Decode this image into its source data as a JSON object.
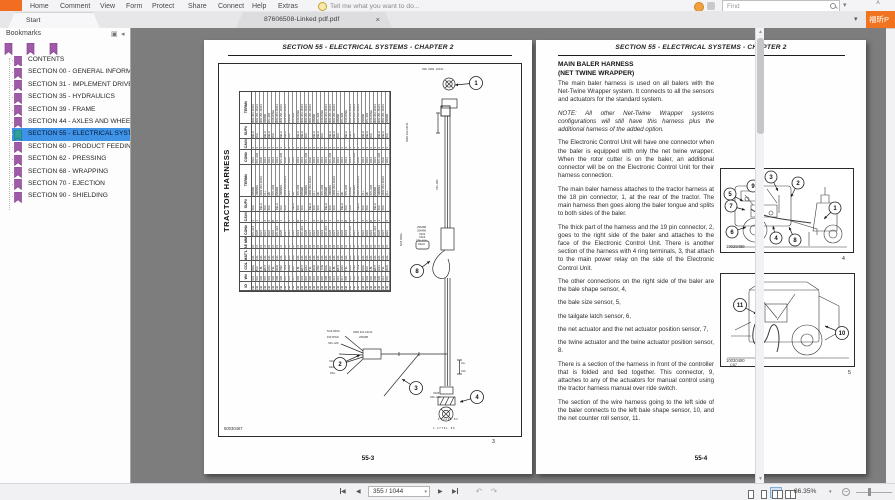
{
  "menubar": {
    "items": [
      "Home",
      "Comment",
      "View",
      "Form",
      "Protect",
      "Share",
      "Connect",
      "Help",
      "Extras"
    ],
    "assistant_hint": "Tell me what you want to do...",
    "find_placeholder": "Find",
    "brand_button": "福昕P"
  },
  "tabs": {
    "start": "Start",
    "document": "87606508-Linked pdf.pdf",
    "close": "×"
  },
  "bookmarks": {
    "title": "Bookmarks",
    "selected_index": 6,
    "items": [
      "CONTENTS",
      "SECTION 00 - GENERAL INFORMATIO",
      "SECTION 31 - IMPLEMENT DRIVELINE",
      "SECTION 35 - HYDRAULICS",
      "SECTION 39 - FRAME",
      "SECTION 44 - AXLES AND WHEELS",
      "SECTION 55 - ELECTRICAL SYSTEMS",
      "SECTION 60 - PRODUCT FEEDING",
      "SECTION 62 - PRESSING",
      "SECTION 68 - WRAPPING",
      "SECTION 70 - EJECTION",
      "SECTION 90 - SHIELDING"
    ]
  },
  "doc": {
    "left_page": {
      "header": "SECTION 55 - ELECTRICAL SYSTEMS - CHAPTER 2",
      "page_number": "55-3",
      "figure": {
        "title": "TRACTOR HARNESS",
        "image_id": "50030467",
        "figure_number": "3",
        "table": {
          "row_headers": [
            "TERM#",
            "SUP#",
            "CAV#",
            "CON#",
            "TERM#",
            "SUP#",
            "CAV#",
            "CON#",
            "SAE MM2",
            "MAT'L",
            "COL",
            "W#",
            "ID"
          ],
          "band_heights": [
            34,
            15,
            11,
            15,
            34,
            15,
            11,
            15,
            12,
            12,
            10,
            10,
            9
          ],
          "columns": 34,
          "pools": [
            [
              "0482 203-16141",
              "0482 201-16141",
              "0462 201-16141",
              "296488",
              "SPL-429",
              "5/16 RING"
            ],
            [
              "DELU",
              "-",
              "PAC",
              "DELU"
            ],
            [
              "1",
              "A",
              "C",
              "J",
              "2",
              "-",
              "3"
            ],
            [
              "X012",
              "X012",
              "X013",
              "X021",
              "SPL-004",
              "X032"
            ],
            [
              "296488",
              "2965891",
              "0482 203-16141",
              "21+",
              "3/b",
              "SPL-004"
            ],
            [
              "PAC",
              "DELU",
              "-",
              "PAC"
            ],
            [
              "3",
              "1",
              "-",
              "4",
              "2",
              "B"
            ],
            [
              "X021",
              "X022",
              "X023",
              "SPL-014",
              "X025",
              "X027"
            ],
            [
              "0.8",
              "1.0",
              "0.8",
              "2.0"
            ],
            [
              "GXL",
              "GXL",
              "GXL"
            ],
            [
              "RED",
              "BLK",
              "YEL",
              "ORG",
              "GRA",
              "TAN",
              "WHT",
              "PNK",
              "LBL"
            ],
            [
              "001",
              "003",
              "005",
              "008",
              "010",
              "012",
              "015",
              "017",
              "020",
              "023",
              "026",
              "030"
            ],
            [
              "CM"
            ]
          ]
        },
        "callouts": [
          {
            "n": "1",
            "cx": 257,
            "cy": 19,
            "tx": 236,
            "ty": 21
          },
          {
            "n": "8",
            "cx": 198,
            "cy": 207,
            "tx": 211,
            "ty": 197
          },
          {
            "n": "2",
            "cx": 121,
            "cy": 300,
            "tx": 141,
            "ty": 291
          },
          {
            "n": "3",
            "cx": 197,
            "cy": 324,
            "tx": 183,
            "ty": 315
          },
          {
            "n": "4",
            "cx": 258,
            "cy": 333,
            "tx": 241,
            "ty": 338
          }
        ],
        "micro_labels": [
          {
            "x": 203,
            "y": 6,
            "t": "298· 0482 ·16141 ··"
          },
          {
            "x": 189,
            "y": 78,
            "t": "0482 201-16141",
            "r": 1
          },
          {
            "x": 219,
            "y": 126,
            "t": "SPL-004",
            "r": 1
          },
          {
            "x": 183,
            "y": 182,
            "t": "5/16 RING",
            "r": 1
          },
          {
            "x": 198,
            "y": 164,
            "t": "296488"
          },
          {
            "x": 198,
            "y": 167.4,
            "t": "296489"
          },
          {
            "x": 200,
            "y": 170.8,
            "t": "X022"
          },
          {
            "x": 200,
            "y": 174.2,
            "t": "X023"
          },
          {
            "x": 197,
            "y": 177.6,
            "t": "SPL-014"
          },
          {
            "x": 199,
            "y": 181,
            "t": "DELU"
          },
          {
            "x": 134,
            "y": 269,
            "t": "0482 201-16141"
          },
          {
            "x": 140,
            "y": 274,
            "t": "296488"
          },
          {
            "x": 108,
            "y": 268,
            "t": "5/16 RING"
          },
          {
            "x": 108,
            "y": 274,
            "t": "#16 RING"
          },
          {
            "x": 109,
            "y": 280,
            "t": "SPL-429"
          },
          {
            "x": 110,
            "y": 298,
            "t": "X027"
          },
          {
            "x": 110,
            "y": 304,
            "t": "DELU"
          },
          {
            "x": 111,
            "y": 310,
            "t": "PAC"
          },
          {
            "x": 242,
            "y": 300,
            "t": "21+"
          },
          {
            "x": 242,
            "y": 308,
            "t": "31b"
          },
          {
            "x": 214,
            "y": 330,
            "t": "X025"
          },
          {
            "x": 211,
            "y": 334,
            "t": "SPL-413"
          },
          {
            "x": 218,
            "y": 356,
            "t": "·5 ·1 2 2 3 1 ··8 2"
          },
          {
            "x": 214,
            "y": 365,
            "t": "1·· 2 7 7 8 1 ·· 8 8"
          }
        ]
      }
    },
    "right_page": {
      "header": "SECTION 55 - ELECTRICAL SYSTEMS - CHAPTER 2",
      "page_number": "55-4",
      "title_line1": "MAIN BALER HARNESS",
      "title_line2": "(NET TWINE WRAPPER)",
      "paragraphs": [
        {
          "text": "The main baler harness is used on all balers with the Net-Twine Wrapper system. It connects to all the sensors and actuators for the standard system.",
          "italic": false
        },
        {
          "text": "NOTE: All other Net-Twine Wrapper systems configurations will still have this harness plus the additional harness of the added option.",
          "italic": true
        },
        {
          "text": "The Electronic Control Unit will have one connector when the baler is equipped with only the net twine wrapper. When the rotor cutter is on the baler, an additional connector will be on the Electronic Control Unit for their harness connection.",
          "italic": false
        },
        {
          "text": "The main baler harness attaches to the tractor harness at the 18 pin connector, 1, at the rear of the tractor. The main harness then goes along the baler tongue and splits to both sides of the baler.",
          "italic": false
        },
        {
          "text": "The thick part of the harness and the 19 pin connector, 2, goes to the right side of the baler and attaches to the face of the Electronic Control Unit. There is another section of the harness with 4 ring terminals, 3, that attach to the main power relay on the side of the Electronic Control Unit.",
          "italic": false
        },
        {
          "text": "The other connections on the right side of the baler are the bale shape sensor, 4,",
          "italic": false
        },
        {
          "text": "the bale size sensor, 5,",
          "italic": false
        },
        {
          "text": "the tailgate latch sensor, 6,",
          "italic": false
        },
        {
          "text": "the net actuator and the net actuator position sensor, 7,",
          "italic": false
        },
        {
          "text": "the twine actuator and the twine actuator position sensor, 8.",
          "italic": false
        },
        {
          "text": "There is a section of the harness in front of the controller that is folded and tied together. This connector, 9, attaches to any of the actuators for manual control using the tractor harness manual over ride switch.",
          "italic": false
        },
        {
          "text": "The section of the wire harness going to the left side of the baler connects to the left bale shape sensor, 10, and the net counter roll sensor, 11.",
          "italic": false
        }
      ],
      "figures": [
        {
          "image_id": "10029489",
          "figure_number": "4",
          "callouts": [
            {
              "n": "3",
              "cx": 50,
              "cy": 8,
              "tx": 57,
              "ty": 22
            },
            {
              "n": "2",
              "cx": 77,
              "cy": 14,
              "tx": 70,
              "ty": 28
            },
            {
              "n": "9",
              "cx": 32,
              "cy": 17,
              "tx": 42,
              "ty": 30
            },
            {
              "n": "5",
              "cx": 9,
              "cy": 25,
              "tx": 22,
              "ty": 32
            },
            {
              "n": "7",
              "cx": 10,
              "cy": 37,
              "tx": 24,
              "ty": 41
            },
            {
              "n": "1",
              "cx": 114,
              "cy": 39,
              "tx": 103,
              "ty": 50
            },
            {
              "n": "6",
              "cx": 11,
              "cy": 63,
              "tx": 25,
              "ty": 58
            },
            {
              "n": "4",
              "cx": 55,
              "cy": 69,
              "tx": 52,
              "ty": 57
            },
            {
              "n": "8",
              "cx": 74,
              "cy": 71,
              "tx": 68,
              "ty": 58
            }
          ]
        },
        {
          "image_id": "10030490",
          "sub_id": "C87",
          "figure_number": "5",
          "callouts": [
            {
              "n": "11",
              "cx": 19,
              "cy": 31,
              "tx": 36,
              "ty": 40
            },
            {
              "n": "10",
              "cx": 121,
              "cy": 59,
              "tx": 104,
              "ty": 52
            }
          ]
        }
      ]
    }
  },
  "statusbar": {
    "page_field": "355 / 1044",
    "zoom_value": "86.35%"
  }
}
